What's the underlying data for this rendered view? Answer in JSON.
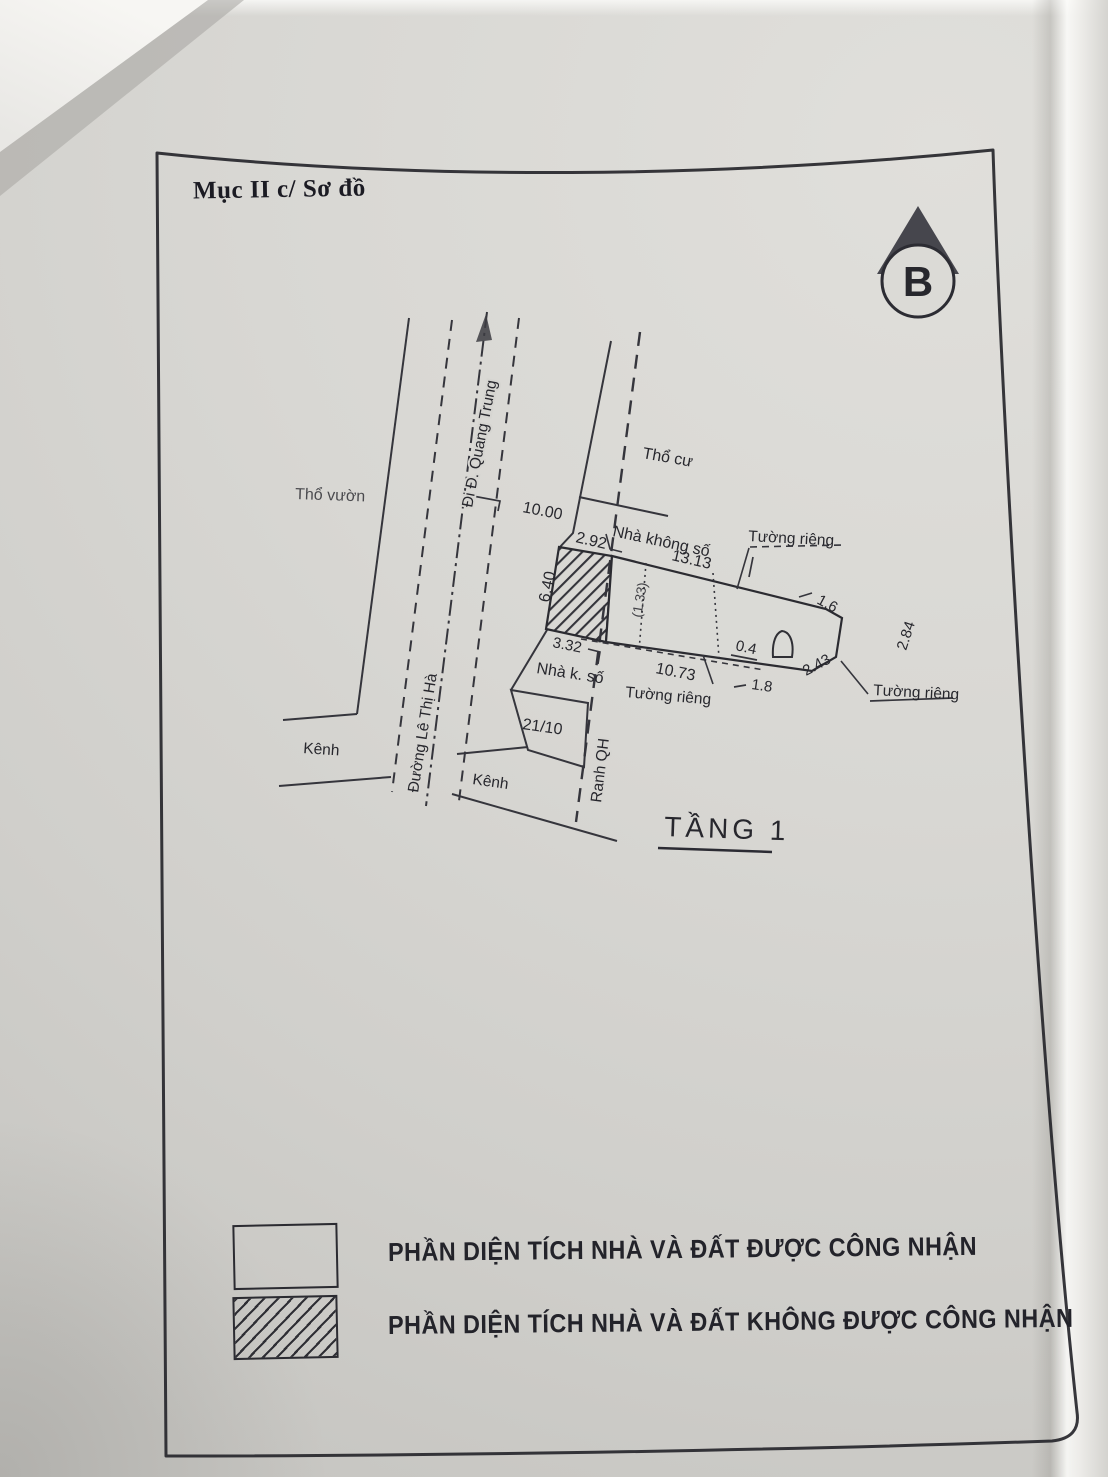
{
  "document": {
    "title": "Mục II c/ Sơ đồ"
  },
  "north_arrow": {
    "letter": "B"
  },
  "plan": {
    "floor_title": "TẦNG 1",
    "area_labels": {
      "garden": "Thổ vườn",
      "residential": "Thổ cư",
      "to_quang_trung": "Đi Đ. Quang Trung",
      "le_thi_ha_street": "Đường Lê Thị Hà",
      "planning_boundary": "Ranh QH",
      "canal_left": "Kênh",
      "canal_right": "Kênh",
      "plot_number": "21/10",
      "house_no_number_top": "Nhà không số",
      "house_no_number_left": "Nhà k. số",
      "private_wall_top": "Tường riêng",
      "private_wall_bottom_left": "Tường riêng",
      "private_wall_bottom_right": "Tường riêng"
    },
    "dimensions": {
      "road_frontage": "10.00",
      "hatched_top": "2.92",
      "hatched_left": "6.40",
      "hatched_bottom": "3.32",
      "house_top": "13.13",
      "house_bottom": "10.73",
      "inner_partition": "(1.33)",
      "edge_1_6": "1.6",
      "edge_2_84": "2.84",
      "edge_2_43": "2.43",
      "wall_0_4": "0.4",
      "edge_1_8": "1.8"
    }
  },
  "legend": {
    "recognized": "PHẦN DIỆN TÍCH NHÀ VÀ ĐẤT ĐƯỢC CÔNG NHẬN",
    "not_recognized": "PHẦN DIỆN TÍCH NHÀ VÀ ĐẤT KHÔNG ĐƯỢC CÔNG NHẬN"
  },
  "colors": {
    "paper": "#d6d5d1",
    "ink": "#26262c",
    "fold_white": "#f2f1ee"
  }
}
